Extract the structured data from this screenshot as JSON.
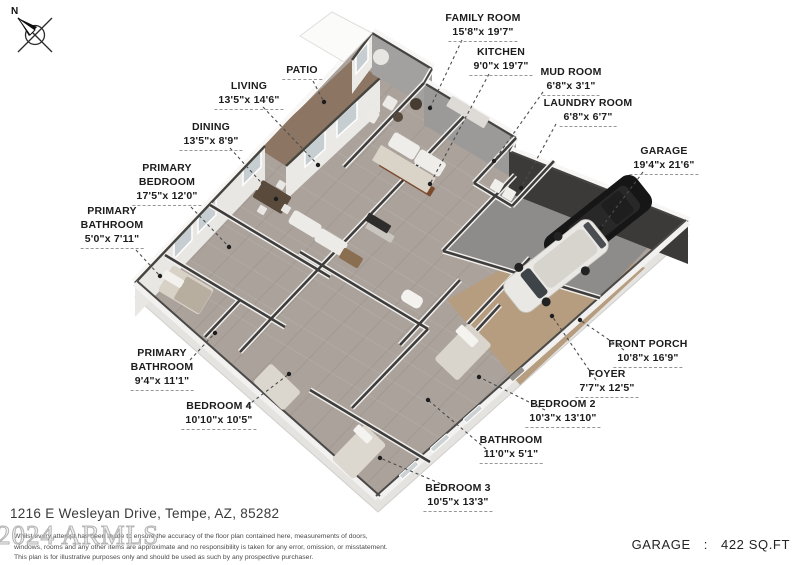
{
  "meta": {
    "address": "1216 E Wesleyan Drive, Tempe, AZ, 85282",
    "watermark": "2024 ARMLS"
  },
  "compass": {
    "label": "N"
  },
  "rooms": [
    {
      "id": "family-room",
      "name": [
        "FAMILY ROOM"
      ],
      "dims": "15'8\"x 19'7\""
    },
    {
      "id": "kitchen",
      "name": [
        "KITCHEN"
      ],
      "dims": "9'0\"x 19'7\""
    },
    {
      "id": "mud-room",
      "name": [
        "MUD ROOM"
      ],
      "dims": "6'8\"x 3'1\""
    },
    {
      "id": "laundry-room",
      "name": [
        "LAUNDRY ROOM"
      ],
      "dims": "6'8\"x 6'7\""
    },
    {
      "id": "garage",
      "name": [
        "GARAGE"
      ],
      "dims": "19'4\"x 21'6\""
    },
    {
      "id": "patio",
      "name": [
        "PATIO"
      ],
      "dims": ""
    },
    {
      "id": "living",
      "name": [
        "LIVING"
      ],
      "dims": "13'5\"x 14'6\""
    },
    {
      "id": "dining",
      "name": [
        "DINING"
      ],
      "dims": "13'5\"x 8'9\""
    },
    {
      "id": "primary-bedroom",
      "name": [
        "PRIMARY",
        "BEDROOM"
      ],
      "dims": "17'5\"x 12'0\""
    },
    {
      "id": "primary-bathroom-1",
      "name": [
        "PRIMARY",
        "BATHROOM"
      ],
      "dims": "5'0\"x 7'11\""
    },
    {
      "id": "primary-bathroom-2",
      "name": [
        "PRIMARY",
        "BATHROOM"
      ],
      "dims": "9'4\"x 11'1\""
    },
    {
      "id": "bedroom-4",
      "name": [
        "BEDROOM 4"
      ],
      "dims": "10'10\"x 10'5\""
    },
    {
      "id": "bedroom-3",
      "name": [
        "BEDROOM 3"
      ],
      "dims": "10'5\"x 13'3\""
    },
    {
      "id": "bathroom",
      "name": [
        "BATHROOM"
      ],
      "dims": "11'0\"x 5'1\""
    },
    {
      "id": "bedroom-2",
      "name": [
        "BEDROOM 2"
      ],
      "dims": "10'3\"x 13'10\""
    },
    {
      "id": "foyer",
      "name": [
        "FOYER"
      ],
      "dims": "7'7\"x 12'5\""
    },
    {
      "id": "front-porch",
      "name": [
        "FRONT PORCH"
      ],
      "dims": "10'8\"x 16'9\""
    }
  ],
  "disclaimer": {
    "lines": [
      "Whilst every attempt has been made to ensure the accuracy of the floor plan contained here, measurements of doors,",
      "windows, rooms and any other items are approximate and no responsibility is taken for any error, omission, or misstatement.",
      "This plan is for illustrative purposes only and should be used as such by any prospective purchaser."
    ]
  },
  "footer": {
    "garage_label": "GARAGE",
    "separator": ":",
    "garage_area": "422 SQ.FT"
  },
  "colors": {
    "floor": "#aaa29b",
    "patio": "#8c7562",
    "porch_foyer": "#b69d7f",
    "garage_floor": "#8e8c8a",
    "wall_top": "#3e3d3b",
    "label_text": "#1c1c1c"
  }
}
